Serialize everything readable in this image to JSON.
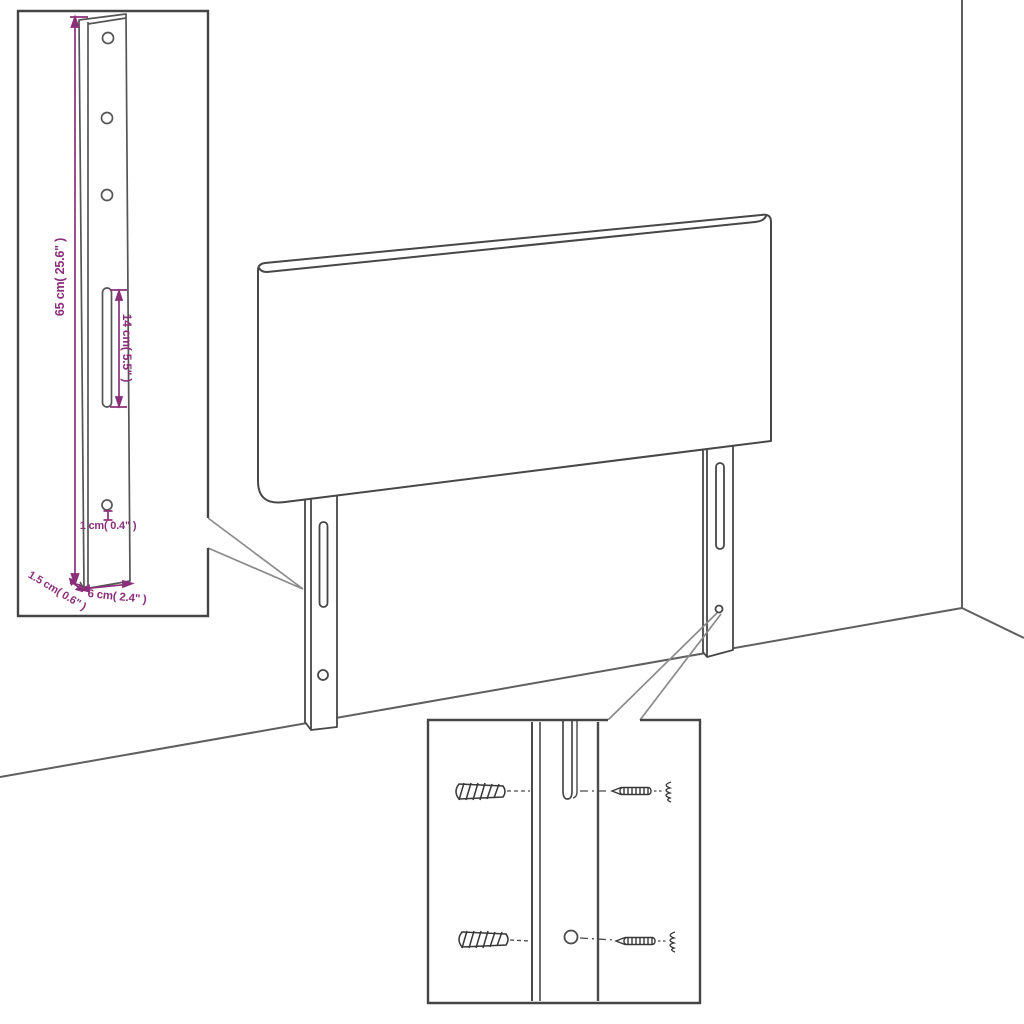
{
  "page": {
    "description": "Product dimension diagram of an upholstered headboard with two mounting legs, a zoom inset of a leg with measurements, and a zoom inset of wall-plug and screw mounting hardware",
    "background": "#ffffff"
  },
  "colors": {
    "dimension_accent": "#8b2f7a",
    "drawing_outline": "#4a4a4a",
    "room_line": "#5f5f5f"
  },
  "bracket_inset": {
    "labels": {
      "height": "65 cm( 25.6\" )",
      "slot": "14 cm( 5.5\" )",
      "hole": "1 cm( 0.4\" )",
      "thickness": "1.5 cm( 0.6\" )",
      "width": "6 cm( 2.4\" )"
    }
  }
}
